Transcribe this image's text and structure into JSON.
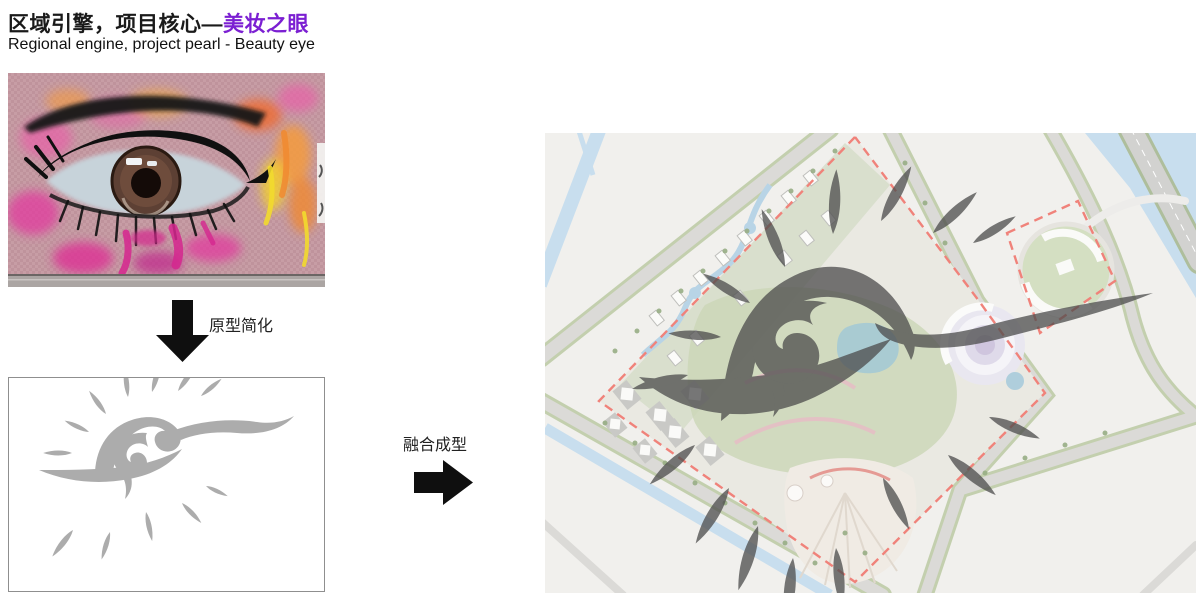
{
  "header": {
    "title_zh_prefix": "区域引擎，项目核心—",
    "title_zh_accent": "美妆之眼",
    "title_en": "Regional engine, project pearl - Beauty eye"
  },
  "process": {
    "step1_label": "原型简化",
    "step2_label": "融合成型"
  },
  "icons": {
    "step1": "down-arrow-icon",
    "step2": "right-arrow-icon"
  },
  "figures": {
    "photo": "graffiti-eye-mural-photo",
    "sketch": "eye-logo-sketch",
    "plan": "site-masterplan-with-eye-overlay"
  },
  "colors": {
    "accent_purple": "#7b1fd2",
    "text_black": "#1a1a1a",
    "logo_gray": "#acacac",
    "eye_overlay_gray": "#4e4e4e",
    "boundary_red_dash": "#f0827a",
    "water_blue": "#c8deee",
    "park_green": "#cbd5b9",
    "mural_pink": "#e23a9e",
    "mural_orange": "#f08a30",
    "mural_yellow": "#f2da2e"
  }
}
